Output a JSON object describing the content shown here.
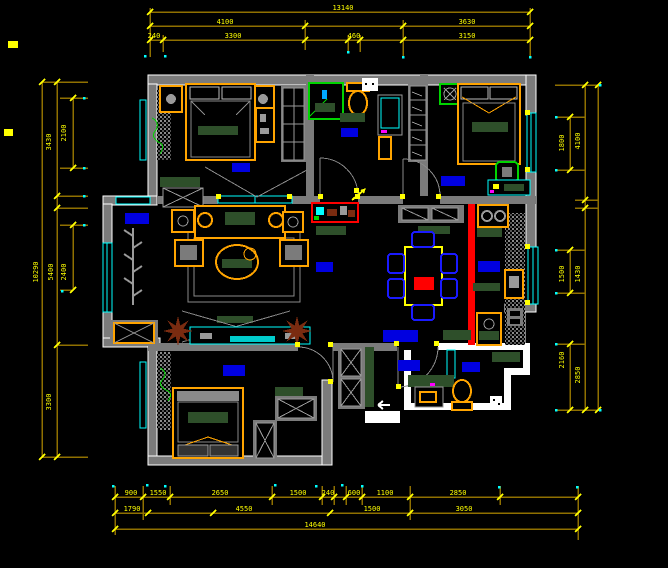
{
  "meta": {
    "title": "residential apartment floor plan - CAD drawing view",
    "canvas_width": 668,
    "canvas_height": 568
  },
  "palette": {
    "background": "#000000",
    "wall_gray": "#7b7b7b",
    "detail_gray": "#9a9a9a",
    "outline_white": "#ffffff",
    "furniture_orange": "#ffa400",
    "dim_line_olive": "#8f7000",
    "dim_yellow": "#ffff00",
    "window_cyan": "#00ffff",
    "rug_green": "#2e4f2a",
    "symbol_green": "#00d400",
    "label_blue": "#0000e0",
    "accent_red": "#ff0000",
    "plant_brown": "#7a2b10",
    "dot_magenta": "#ff00ff"
  },
  "annotations": {
    "h_dim_lines": [
      {
        "x1": 150,
        "x2": 530,
        "y": 12
      },
      {
        "x1": 150,
        "x2": 530,
        "y": 26
      },
      {
        "x1": 150,
        "x2": 530,
        "y": 40
      },
      {
        "x1": 42,
        "x2": 88,
        "y": 82
      },
      {
        "x1": 42,
        "x2": 88,
        "y": 457
      },
      {
        "x1": 57,
        "x2": 88,
        "y": 196
      },
      {
        "x1": 57,
        "x2": 88,
        "y": 208
      },
      {
        "x1": 57,
        "x2": 88,
        "y": 345
      },
      {
        "x1": 60,
        "x2": 88,
        "y": 98
      },
      {
        "x1": 60,
        "x2": 88,
        "y": 168
      },
      {
        "x1": 60,
        "x2": 88,
        "y": 225
      },
      {
        "x1": 60,
        "x2": 73,
        "y": 290
      },
      {
        "x1": 115,
        "x2": 578,
        "y": 497
      },
      {
        "x1": 115,
        "x2": 578,
        "y": 513
      },
      {
        "x1": 115,
        "x2": 578,
        "y": 529
      },
      {
        "x1": 555,
        "x2": 600,
        "y": 85
      },
      {
        "x1": 555,
        "x2": 585,
        "y": 117
      },
      {
        "x1": 555,
        "x2": 585,
        "y": 170
      },
      {
        "x1": 575,
        "x2": 598,
        "y": 200
      },
      {
        "x1": 575,
        "x2": 598,
        "y": 208
      },
      {
        "x1": 555,
        "x2": 585,
        "y": 250
      },
      {
        "x1": 555,
        "x2": 585,
        "y": 293
      },
      {
        "x1": 555,
        "x2": 585,
        "y": 344
      },
      {
        "x1": 555,
        "x2": 600,
        "y": 410
      }
    ],
    "v_dim_lines": [
      {
        "y1": 8,
        "y2": 57,
        "x": 150
      },
      {
        "y1": 35,
        "y2": 52,
        "x": 163
      },
      {
        "y1": 20,
        "y2": 50,
        "x": 305
      },
      {
        "y1": 35,
        "y2": 52,
        "x": 348
      },
      {
        "y1": 35,
        "y2": 52,
        "x": 360
      },
      {
        "y1": 20,
        "y2": 57,
        "x": 403
      },
      {
        "y1": 8,
        "y2": 57,
        "x": 530
      },
      {
        "y1": 82,
        "y2": 457,
        "x": 42
      },
      {
        "y1": 82,
        "y2": 457,
        "x": 57
      },
      {
        "y1": 98,
        "y2": 168,
        "x": 73
      },
      {
        "y1": 225,
        "y2": 290,
        "x": 73
      },
      {
        "y1": 85,
        "y2": 410,
        "x": 585
      },
      {
        "y1": 85,
        "y2": 410,
        "x": 598
      },
      {
        "y1": 117,
        "y2": 170,
        "x": 570
      },
      {
        "y1": 250,
        "y2": 293,
        "x": 570
      },
      {
        "y1": 344,
        "y2": 410,
        "x": 570
      },
      {
        "y1": 486,
        "y2": 535,
        "x": 115
      },
      {
        "y1": 486,
        "y2": 520,
        "x": 143
      },
      {
        "y1": 486,
        "y2": 505,
        "x": 170
      },
      {
        "y1": 486,
        "y2": 505,
        "x": 272
      },
      {
        "y1": 486,
        "y2": 505,
        "x": 322
      },
      {
        "y1": 486,
        "y2": 505,
        "x": 334
      },
      {
        "y1": 486,
        "y2": 505,
        "x": 346
      },
      {
        "y1": 486,
        "y2": 505,
        "x": 362
      },
      {
        "y1": 486,
        "y2": 520,
        "x": 410
      },
      {
        "y1": 486,
        "y2": 505,
        "x": 500
      },
      {
        "y1": 486,
        "y2": 540,
        "x": 578
      }
    ],
    "ticks": [
      [
        150,
        12
      ],
      [
        530,
        12
      ],
      [
        150,
        26
      ],
      [
        305,
        26
      ],
      [
        403,
        26
      ],
      [
        530,
        26
      ],
      [
        150,
        40
      ],
      [
        163,
        40
      ],
      [
        305,
        40
      ],
      [
        348,
        40
      ],
      [
        360,
        40
      ],
      [
        403,
        40
      ],
      [
        530,
        40
      ],
      [
        42,
        82
      ],
      [
        42,
        457
      ],
      [
        57,
        82
      ],
      [
        57,
        196
      ],
      [
        57,
        208
      ],
      [
        57,
        345
      ],
      [
        57,
        457
      ],
      [
        73,
        98
      ],
      [
        73,
        168
      ],
      [
        73,
        225
      ],
      [
        73,
        290
      ],
      [
        585,
        85
      ],
      [
        585,
        200
      ],
      [
        585,
        208
      ],
      [
        585,
        410
      ],
      [
        598,
        85
      ],
      [
        598,
        410
      ],
      [
        570,
        117
      ],
      [
        570,
        170
      ],
      [
        570,
        250
      ],
      [
        570,
        293
      ],
      [
        570,
        344
      ],
      [
        570,
        410
      ],
      [
        115,
        497
      ],
      [
        143,
        497
      ],
      [
        170,
        497
      ],
      [
        272,
        497
      ],
      [
        322,
        497
      ],
      [
        334,
        497
      ],
      [
        346,
        497
      ],
      [
        362,
        497
      ],
      [
        410,
        497
      ],
      [
        500,
        497
      ],
      [
        578,
        497
      ],
      [
        115,
        513
      ],
      [
        148,
        513
      ],
      [
        213,
        513
      ],
      [
        330,
        513
      ],
      [
        410,
        513
      ],
      [
        578,
        513
      ],
      [
        115,
        529
      ],
      [
        578,
        529
      ]
    ],
    "h_texts": [
      {
        "value": "13140",
        "x": 343,
        "y": 10
      },
      {
        "value": "4100",
        "x": 225,
        "y": 24
      },
      {
        "value": "3630",
        "x": 467,
        "y": 24
      },
      {
        "value": "240",
        "x": 154,
        "y": 38
      },
      {
        "value": "3300",
        "x": 233,
        "y": 38
      },
      {
        "value": "460",
        "x": 354,
        "y": 38
      },
      {
        "value": "3150",
        "x": 467,
        "y": 38
      },
      {
        "value": "900",
        "x": 131,
        "y": 495
      },
      {
        "value": "1550",
        "x": 158,
        "y": 495
      },
      {
        "value": "2650",
        "x": 220,
        "y": 495
      },
      {
        "value": "1500",
        "x": 298,
        "y": 495
      },
      {
        "value": "240",
        "x": 328,
        "y": 495
      },
      {
        "value": "600",
        "x": 354,
        "y": 495
      },
      {
        "value": "1100",
        "x": 385,
        "y": 495
      },
      {
        "value": "2850",
        "x": 458,
        "y": 495
      },
      {
        "value": "1790",
        "x": 132,
        "y": 511
      },
      {
        "value": "4550",
        "x": 244,
        "y": 511
      },
      {
        "value": "1500",
        "x": 372,
        "y": 511
      },
      {
        "value": "3050",
        "x": 464,
        "y": 511
      },
      {
        "value": "14640",
        "x": 315,
        "y": 527
      }
    ],
    "v_texts": [
      {
        "value": "10290",
        "x": 38,
        "y": 272
      },
      {
        "value": "5400",
        "x": 53,
        "y": 272
      },
      {
        "value": "2400",
        "x": 66,
        "y": 272
      },
      {
        "value": "3430",
        "x": 51,
        "y": 142
      },
      {
        "value": "2100",
        "x": 66,
        "y": 133
      },
      {
        "value": "3300",
        "x": 51,
        "y": 402
      },
      {
        "value": "4100",
        "x": 580,
        "y": 141
      },
      {
        "value": "1800",
        "x": 564,
        "y": 143
      },
      {
        "value": "1500",
        "x": 564,
        "y": 274
      },
      {
        "value": "1430",
        "x": 580,
        "y": 274
      },
      {
        "value": "2160",
        "x": 564,
        "y": 360
      },
      {
        "value": "2850",
        "x": 580,
        "y": 375
      }
    ],
    "dots": [
      [
        145,
        56
      ],
      [
        165,
        56
      ],
      [
        348,
        52
      ],
      [
        403,
        57
      ],
      [
        530,
        57
      ],
      [
        113,
        486
      ],
      [
        147,
        485
      ],
      [
        165,
        486
      ],
      [
        275,
        485
      ],
      [
        316,
        486
      ],
      [
        342,
        485
      ],
      [
        362,
        486
      ],
      [
        499,
        487
      ],
      [
        577,
        487
      ],
      [
        556,
        117
      ],
      [
        556,
        170
      ],
      [
        556,
        250
      ],
      [
        556,
        293
      ],
      [
        556,
        344
      ],
      [
        556,
        410
      ],
      [
        600,
        85
      ],
      [
        600,
        410
      ],
      [
        84,
        98
      ],
      [
        84,
        168
      ],
      [
        84,
        196
      ],
      [
        84,
        225
      ],
      [
        62,
        291
      ]
    ],
    "hinge_marks": [
      [
        218,
        196
      ],
      [
        289,
        196
      ],
      [
        320,
        196
      ],
      [
        357,
        196
      ],
      [
        402,
        196
      ],
      [
        438,
        196
      ],
      [
        297,
        344
      ],
      [
        330,
        344
      ],
      [
        396,
        343
      ],
      [
        436,
        343
      ],
      [
        330,
        381
      ],
      [
        398,
        386
      ],
      [
        356,
        190
      ],
      [
        527,
        112
      ],
      [
        527,
        169
      ],
      [
        527,
        246
      ],
      [
        527,
        302
      ]
    ],
    "margin_marks": [
      {
        "x": 8,
        "y": 41,
        "w": 10,
        "h": 7
      },
      {
        "x": 4,
        "y": 129,
        "w": 9,
        "h": 7
      }
    ]
  }
}
